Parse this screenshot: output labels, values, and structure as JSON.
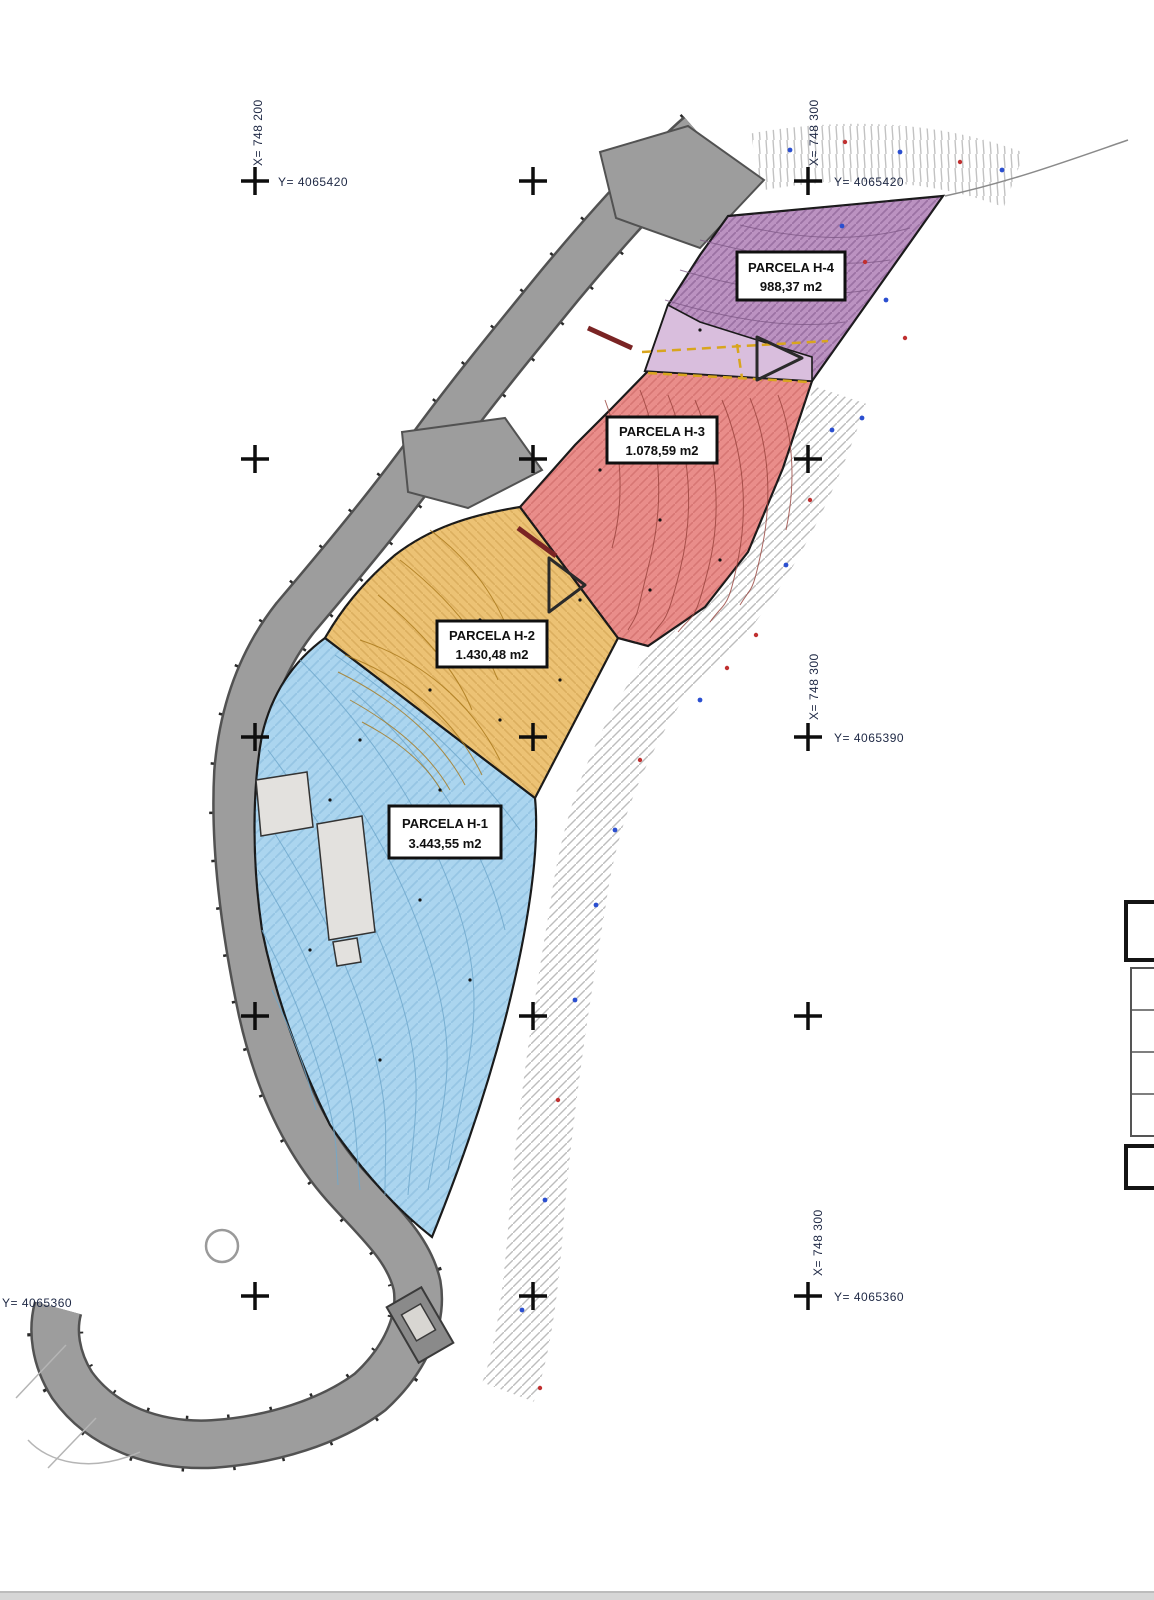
{
  "parcels": [
    {
      "name": "PARCELA H-4",
      "area": "988,37 m2"
    },
    {
      "name": "PARCELA H-3",
      "area": "1.078,59 m2"
    },
    {
      "name": "PARCELA H-2",
      "area": "1.430,48 m2"
    },
    {
      "name": "PARCELA H-1",
      "area": "3.443,55 m2"
    }
  ],
  "grid": {
    "labels": {
      "y_row1": "Y= 4065420",
      "y_row3": "Y= 4065390",
      "y_row5": "Y= 4065360",
      "x_col_left": "X= 748 200",
      "x_col_right": "X= 748 300"
    }
  },
  "colors": {
    "parcel_h4": "#bb92c1",
    "parcel_h4_light": "#d9bedd",
    "parcel_h3": "#e98d8a",
    "parcel_h2": "#ecc274",
    "parcel_h1": "#abd5ef",
    "road": "#9d9d9d"
  }
}
